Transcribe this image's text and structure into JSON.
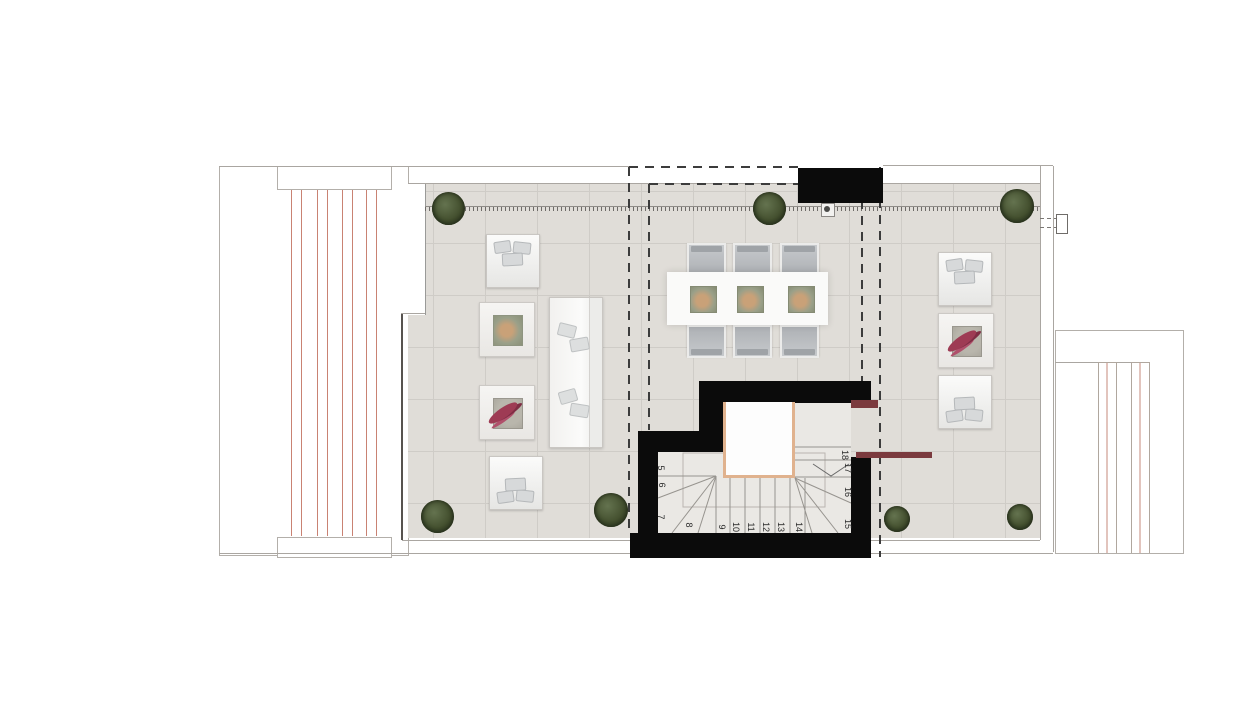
{
  "plan": {
    "kind": "architectural-roof-terrace-floor-plan",
    "stair_step_labels": [
      "5",
      "6",
      "7",
      "8",
      "9",
      "10",
      "11",
      "12",
      "13",
      "14",
      "15",
      "16",
      "17",
      "18"
    ],
    "colors": {
      "background": "#ffffff",
      "floor_tile": "#e0ddd8",
      "tile_grid": "#cfccc7",
      "wall_black": "#0b0b0b",
      "handrail_maroon": "#7b3a3e",
      "landing_trim_tan": "#e0b28e",
      "louvre_line_red": "#c4897b",
      "tree_green": "#44502f",
      "plant_red": "#9e3b54",
      "outline_gray": "#aaa6a1"
    },
    "furniture": {
      "left_group": [
        "armchair",
        "coffee-table-plant",
        "coffee-table-red-plant",
        "armchair",
        "sofa"
      ],
      "dining_group": [
        "dining-table",
        "dining-chairs-x6",
        "table-trays-x3"
      ],
      "right_group": [
        "armchair",
        "coffee-table-red-plant",
        "armchair"
      ],
      "trees_large": 5,
      "trees_small": 2
    }
  }
}
